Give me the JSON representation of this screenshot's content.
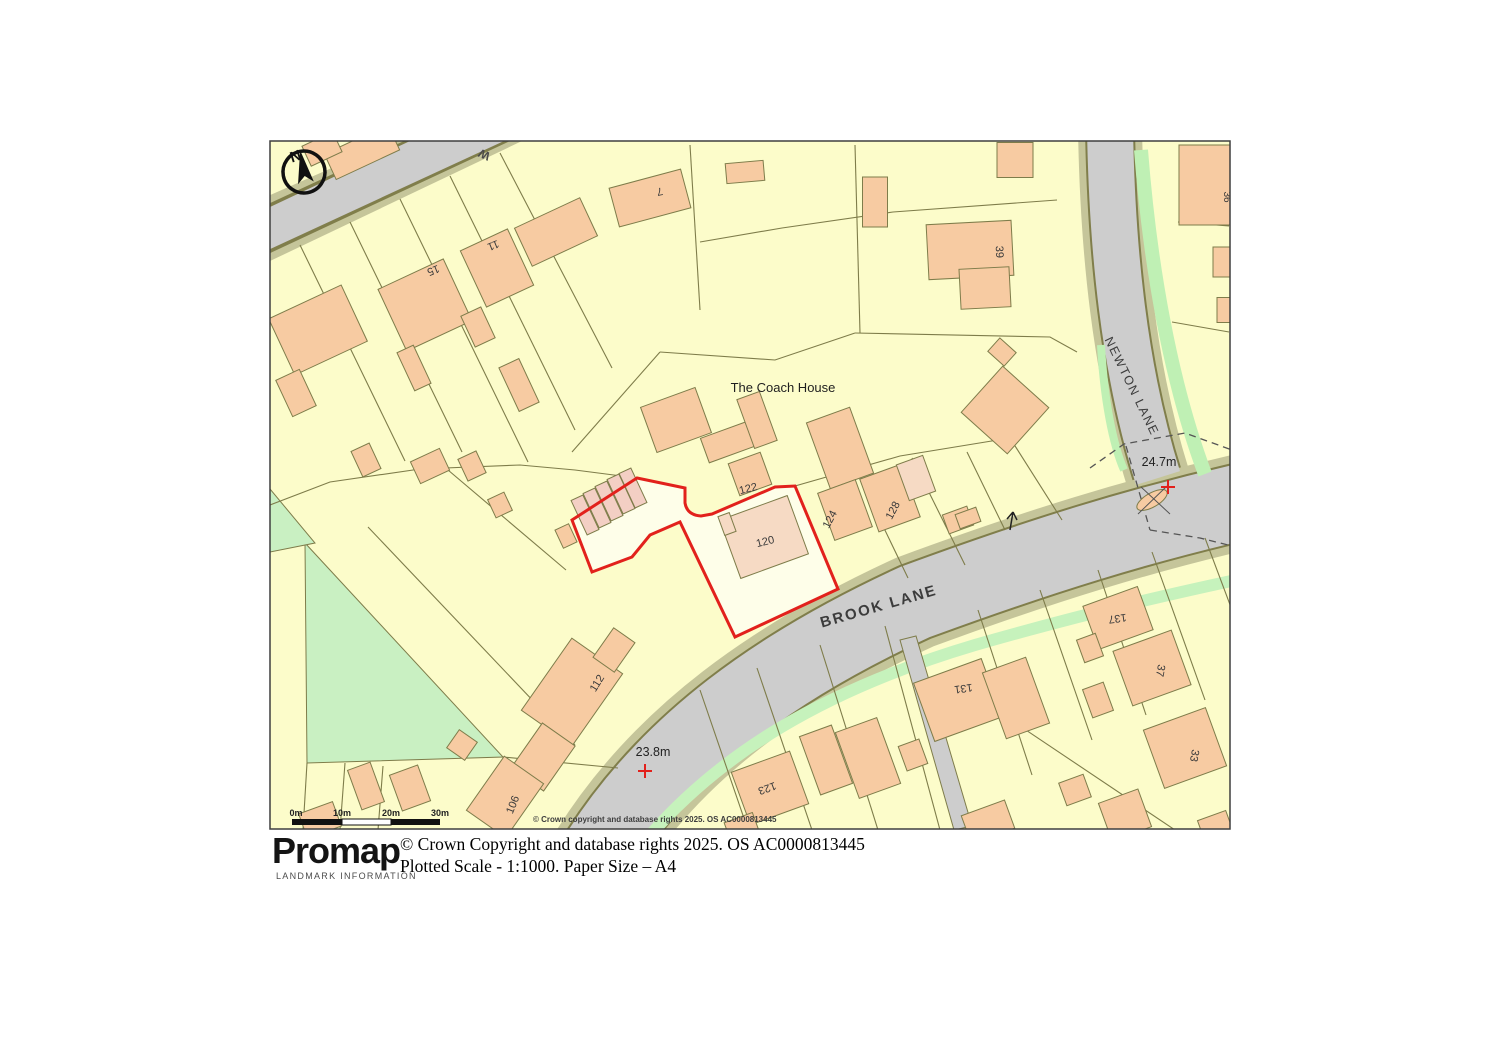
{
  "map": {
    "colors": {
      "boundary_red": "#E2211C",
      "land": "#FCFCCA",
      "selected_plot": "#FEFEE9",
      "building": "#F7CBA2",
      "road": "#CDCDCD",
      "verge": "#C5C59A",
      "green_space": "#C9F0C2"
    },
    "labels": [
      {
        "name": "label-street-fragment",
        "text": "W",
        "x": 486,
        "y": 151,
        "rot": 205,
        "size": 12,
        "weight": "bold",
        "color": "#4a4a4a"
      },
      {
        "name": "label-coach-house",
        "text": "The Coach House",
        "x": 783,
        "y": 392,
        "rot": 0,
        "size": 13,
        "color": "#1f1f1f"
      },
      {
        "name": "label-plot-120",
        "text": "120",
        "x": 766,
        "y": 545,
        "rot": -14,
        "size": 11,
        "color": "#3a3a3a"
      },
      {
        "name": "label-plot-122",
        "text": "122",
        "x": 749,
        "y": 492,
        "rot": -14,
        "size": 11,
        "color": "#3a3a3a"
      },
      {
        "name": "label-plot-124",
        "text": "124",
        "x": 833,
        "y": 521,
        "rot": -62,
        "size": 11,
        "color": "#3a3a3a"
      },
      {
        "name": "label-plot-128",
        "text": "128",
        "x": 896,
        "y": 512,
        "rot": -62,
        "size": 11,
        "color": "#3a3a3a"
      },
      {
        "name": "label-plot-15",
        "text": "15",
        "x": 432,
        "y": 267,
        "rot": 158,
        "size": 11,
        "color": "#3a3a3a"
      },
      {
        "name": "label-plot-11",
        "text": "11",
        "x": 492,
        "y": 242,
        "rot": 158,
        "size": 11,
        "color": "#3a3a3a"
      },
      {
        "name": "label-plot-7",
        "text": "7",
        "x": 659,
        "y": 188,
        "rot": 168,
        "size": 11,
        "color": "#3a3a3a"
      },
      {
        "name": "label-plot-39",
        "text": "39",
        "x": 996,
        "y": 252,
        "rot": 88,
        "size": 11,
        "color": "#3a3a3a"
      },
      {
        "name": "label-plot-36",
        "text": "36",
        "x": 1224,
        "y": 197,
        "rot": 90,
        "size": 10,
        "color": "#3a3a3a"
      },
      {
        "name": "label-plot-137",
        "text": "137",
        "x": 1117,
        "y": 615,
        "rot": 172,
        "size": 11,
        "color": "#3a3a3a"
      },
      {
        "name": "label-plot-37",
        "text": "37",
        "x": 1157,
        "y": 670,
        "rot": 100,
        "size": 11,
        "color": "#3a3a3a"
      },
      {
        "name": "label-plot-33",
        "text": "33",
        "x": 1191,
        "y": 755,
        "rot": 100,
        "size": 11,
        "color": "#3a3a3a"
      },
      {
        "name": "label-plot-131",
        "text": "131",
        "x": 963,
        "y": 685,
        "rot": 172,
        "size": 11,
        "color": "#3a3a3a"
      },
      {
        "name": "label-plot-123",
        "text": "123",
        "x": 766,
        "y": 785,
        "rot": 160,
        "size": 11,
        "color": "#3a3a3a"
      },
      {
        "name": "label-plot-112",
        "text": "112",
        "x": 600,
        "y": 685,
        "rot": -58,
        "size": 11,
        "color": "#3a3a3a"
      },
      {
        "name": "label-plot-106",
        "text": "106",
        "x": 516,
        "y": 806,
        "rot": -68,
        "size": 11,
        "color": "#3a3a3a"
      },
      {
        "name": "label-brook-lane",
        "text": "BROOK LANE",
        "x": 880,
        "y": 611,
        "rot": -16,
        "size": 15,
        "ls": 2,
        "weight": "bold",
        "color": "#3c3c3c"
      },
      {
        "name": "label-newton-lane",
        "text": "NEWTON LANE",
        "x": 1128,
        "y": 388,
        "rot": 64,
        "size": 12.5,
        "ls": 1.5,
        "color": "#3c3c3c"
      },
      {
        "name": "label-spot-height-24-7",
        "text": "24.7m",
        "x": 1159,
        "y": 466,
        "rot": 0,
        "size": 12.5,
        "color": "#222222"
      },
      {
        "name": "label-spot-height-23-8",
        "text": "23.8m",
        "x": 653,
        "y": 756,
        "rot": 0,
        "size": 12.5,
        "color": "#222222"
      },
      {
        "name": "north-letter",
        "text": "N",
        "x": 297,
        "y": 161,
        "rot": -18,
        "size": 15,
        "weight": "bold",
        "color": "#111111"
      },
      {
        "name": "scale-label-0m",
        "text": "0m",
        "x": 296,
        "y": 816,
        "rot": 0,
        "size": 9,
        "weight": "bold",
        "color": "#222222"
      },
      {
        "name": "scale-label-10m",
        "text": "10m",
        "x": 342,
        "y": 816,
        "rot": 0,
        "size": 9,
        "weight": "bold",
        "color": "#222222"
      },
      {
        "name": "scale-label-20m",
        "text": "20m",
        "x": 391,
        "y": 816,
        "rot": 0,
        "size": 9,
        "weight": "bold",
        "color": "#222222"
      },
      {
        "name": "scale-label-30m",
        "text": "30m",
        "x": 440,
        "y": 816,
        "rot": 0,
        "size": 9,
        "weight": "bold",
        "color": "#222222"
      },
      {
        "name": "map-inline-copyright",
        "text": "© Crown copyright and database rights 2025. OS AC0000813445",
        "x": 533,
        "y": 822,
        "rot": 0,
        "size": 8,
        "weight": "bold",
        "color": "#3d3d3d",
        "anchor": "start"
      }
    ]
  },
  "footer": {
    "logo_text": "Promap",
    "logo_subtext": "LANDMARK INFORMATION",
    "logo_dot_color": "#F7941E",
    "copyright_line": "© Crown Copyright and database rights 2025. OS AC0000813445",
    "scale_line": "Plotted Scale - 1:1000. Paper Size – A4"
  }
}
